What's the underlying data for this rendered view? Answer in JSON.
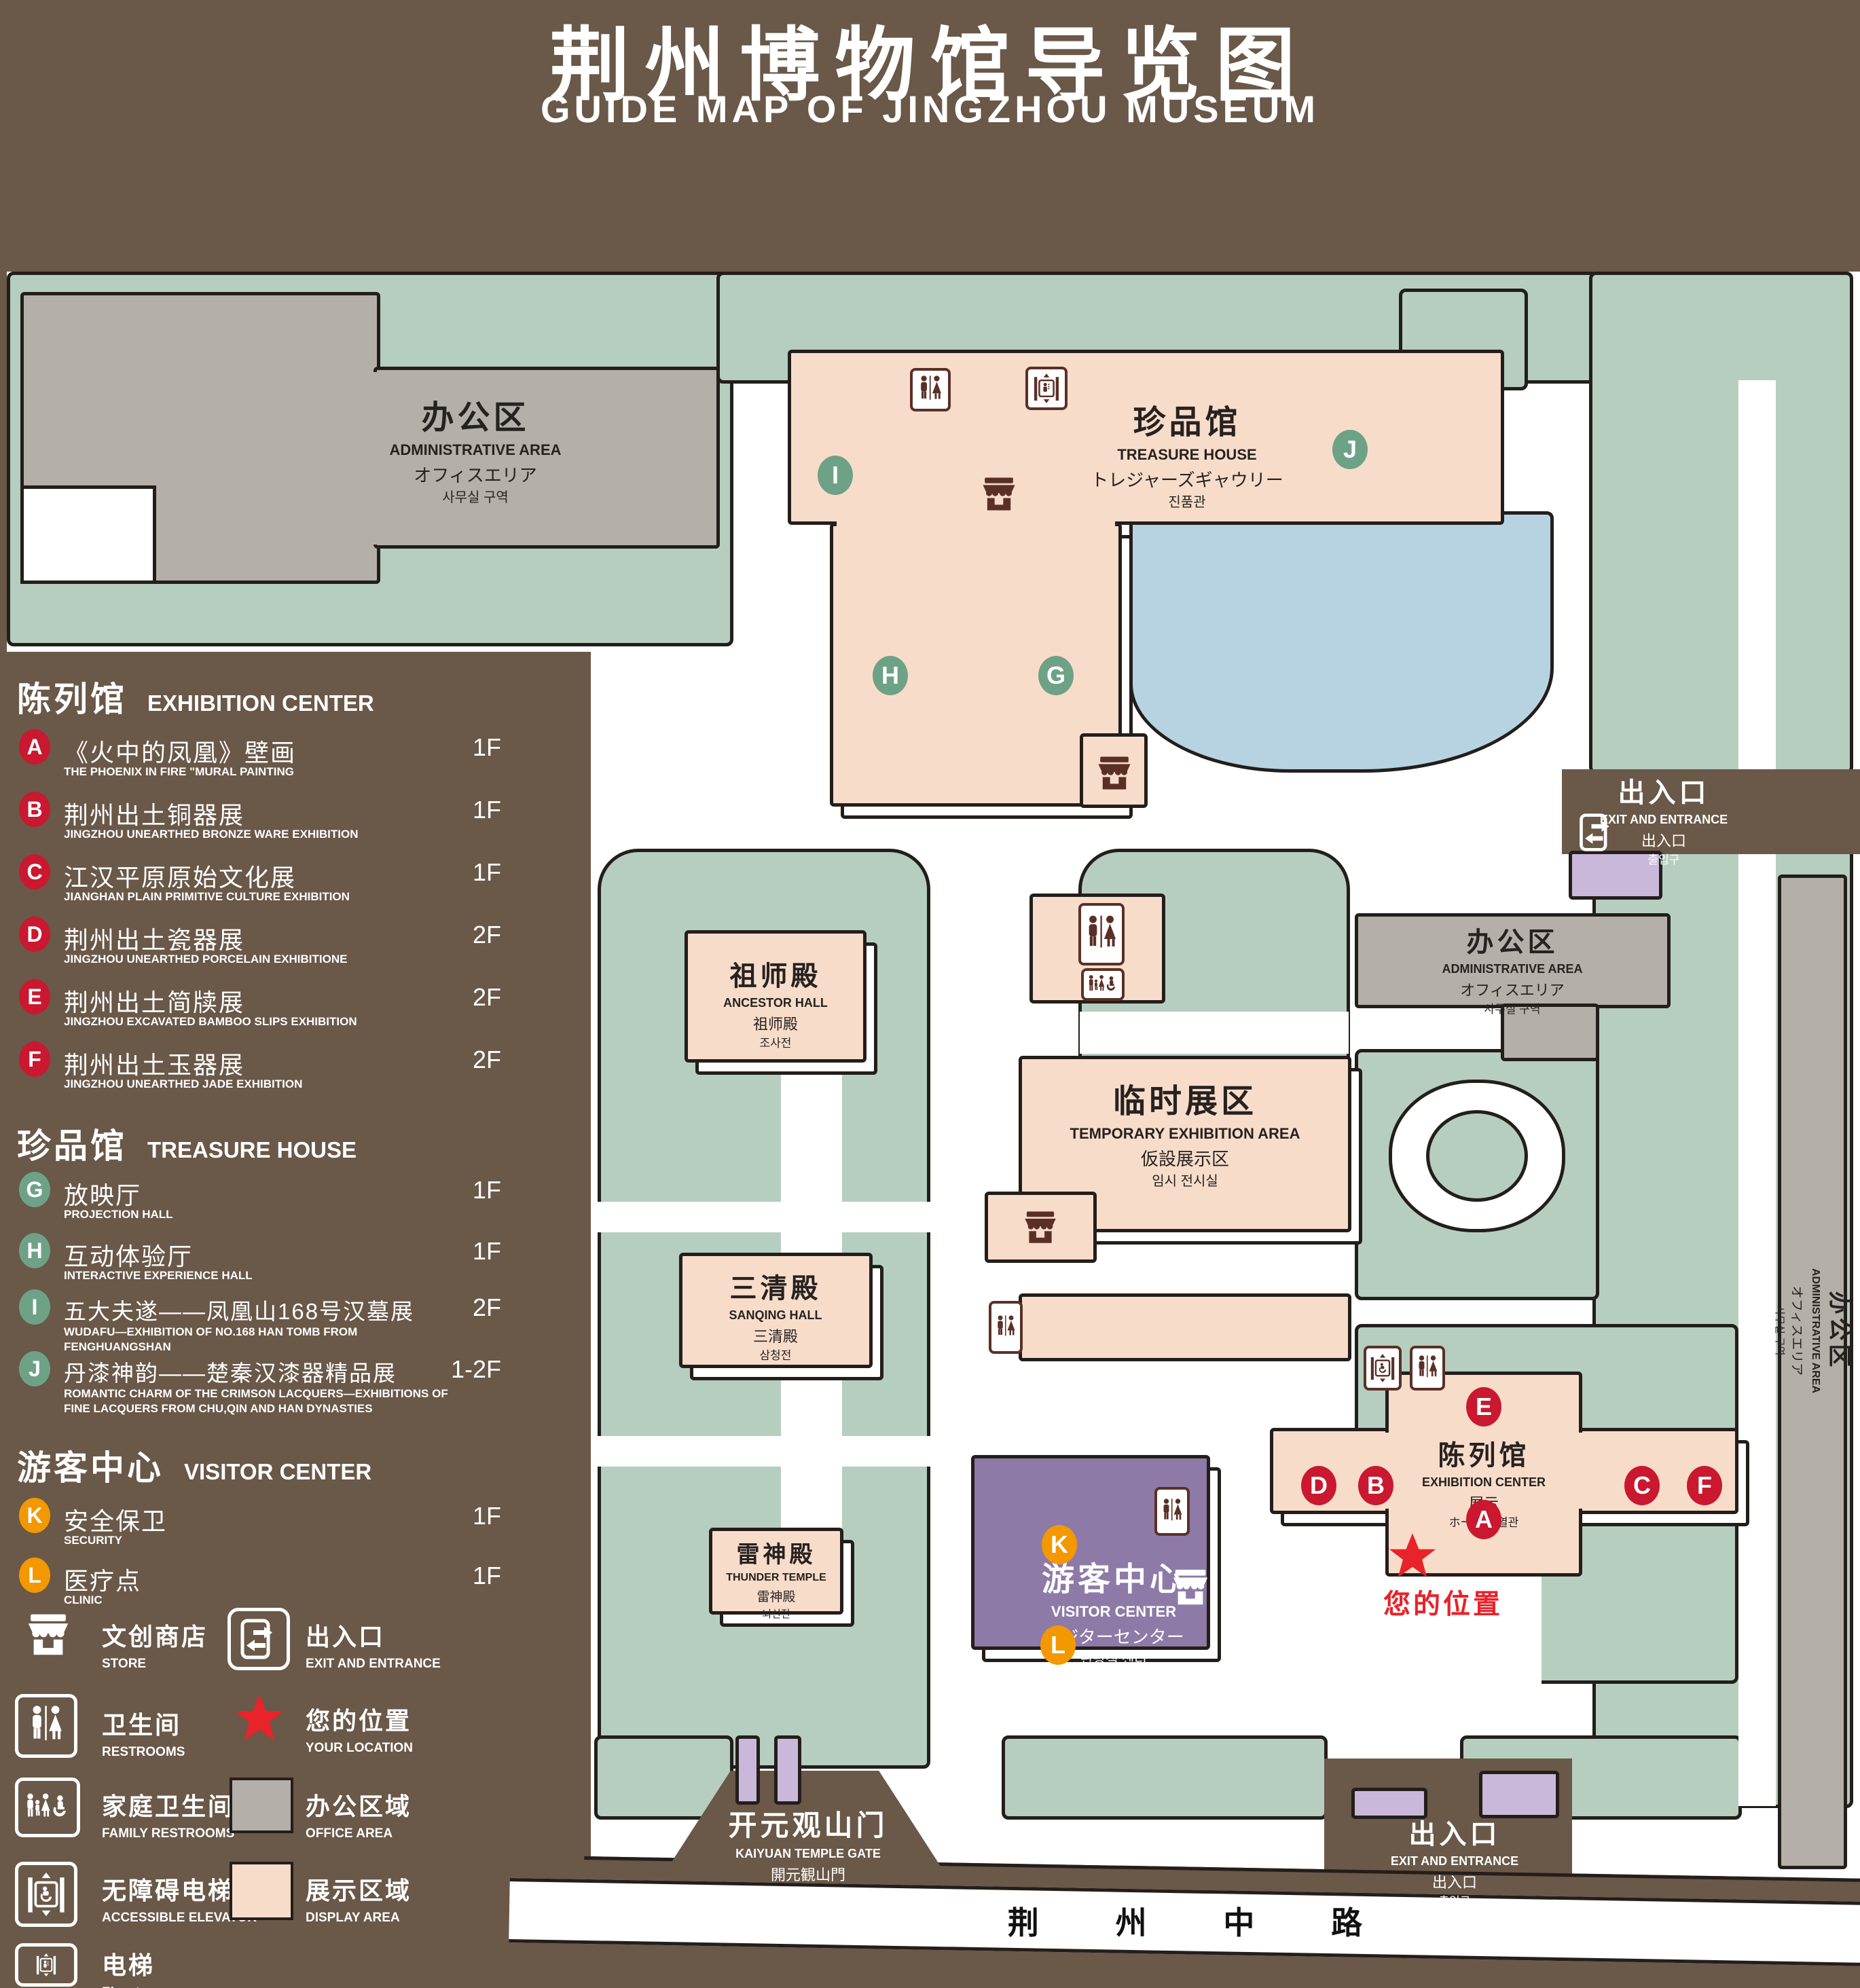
{
  "title": {
    "zh": "荆州博物馆导览图",
    "en": "GUIDE MAP OF JINGZHOU MUSEUM"
  },
  "legend": {
    "sections": [
      {
        "zh": "陈列馆",
        "en": "EXHIBITION CENTER",
        "marker_color": "#c9182f",
        "items": [
          {
            "letter": "A",
            "zh": "《火中的凤凰》壁画",
            "en": "THE PHOENIX IN FIRE \"MURAL PAINTING",
            "floor": "1F"
          },
          {
            "letter": "B",
            "zh": "荆州出土铜器展",
            "en": "JINGZHOU UNEARTHED BRONZE WARE EXHIBITION",
            "floor": "1F"
          },
          {
            "letter": "C",
            "zh": "江汉平原原始文化展",
            "en": "JIANGHAN PLAIN PRIMITIVE CULTURE EXHIBITION",
            "floor": "1F"
          },
          {
            "letter": "D",
            "zh": "荆州出土瓷器展",
            "en": "JINGZHOU UNEARTHED PORCELAIN EXHIBITIONE",
            "floor": "2F"
          },
          {
            "letter": "E",
            "zh": "荆州出土简牍展",
            "en": "JINGZHOU EXCAVATED BAMBOO SLIPS EXHIBITION",
            "floor": "2F"
          },
          {
            "letter": "F",
            "zh": "荆州出土玉器展",
            "en": "JINGZHOU UNEARTHED JADE EXHIBITION",
            "floor": "2F"
          }
        ]
      },
      {
        "zh": "珍品馆",
        "en": "TREASURE HOUSE",
        "marker_color": "#6ea287",
        "items": [
          {
            "letter": "G",
            "zh": "放映厅",
            "en": "PROJECTION HALL",
            "floor": "1F"
          },
          {
            "letter": "H",
            "zh": "互动体验厅",
            "en": "INTERACTIVE EXPERIENCE HALL",
            "floor": "1F"
          },
          {
            "letter": "I",
            "zh": "五大夫遂——凤凰山168号汉墓展",
            "en": "WUDAFU—EXHIBITION OF NO.168 HAN TOMB FROM FENGHUANGSHAN",
            "floor": "2F"
          },
          {
            "letter": "J",
            "zh": "丹漆神韵——楚秦汉漆器精品展",
            "en": "ROMANTIC CHARM OF THE CRIMSON LACQUERS—EXHIBITIONS OF FINE LACQUERS FROM CHU,QIN AND HAN DYNASTIES",
            "floor": "1-2F"
          }
        ]
      },
      {
        "zh": "游客中心",
        "en": "VISITOR CENTER",
        "marker_color": "#f39800",
        "items": [
          {
            "letter": "K",
            "zh": "安全保卫",
            "en": "SECURITY",
            "floor": "1F"
          },
          {
            "letter": "L",
            "zh": "医疗点",
            "en": "CLINIC",
            "floor": "1F"
          }
        ]
      }
    ],
    "symbols_left": [
      {
        "icon": "store-icon",
        "zh": "文创商店",
        "en": "STORE"
      },
      {
        "icon": "restrooms-icon",
        "zh": "卫生间",
        "en": "RESTROOMS"
      },
      {
        "icon": "family-restrooms-icon",
        "zh": "家庭卫生间",
        "en": "FAMILY RESTROOMS"
      },
      {
        "icon": "accessible-elevator-icon",
        "zh": "无障碍电梯",
        "en": "ACCESSIBLE ELEVATOR"
      },
      {
        "icon": "elevator-icon",
        "zh": "电梯",
        "en": "Elevator"
      }
    ],
    "symbols_right": [
      {
        "icon": "exit-icon",
        "zh": "出入口",
        "en": "EXIT AND ENTRANCE"
      },
      {
        "icon": "your-location-icon",
        "zh": "您的位置",
        "en": "YOUR LOCATION"
      },
      {
        "icon": "office-area-swatch",
        "zh": "办公区域",
        "en": "OFFICE AREA",
        "color": "#b4afa9"
      },
      {
        "icon": "display-area-swatch",
        "zh": "展示区域",
        "en": "DISPLAY AREA",
        "color": "#f8dcca"
      }
    ]
  },
  "map": {
    "buildings": {
      "admin_top": {
        "l1": "办公区",
        "l2": "ADMINISTRATIVE AREA",
        "l3": "オフィスエリア",
        "l4": "사무실 구역"
      },
      "treasure_house": {
        "l1": "珍品馆",
        "l2": "TREASURE HOUSE",
        "l3": "トレジャーズギャウリー",
        "l4": "진품관"
      },
      "ancestor_hall": {
        "l1": "祖师殿",
        "l2": "ANCESTOR HALL",
        "l3": "祖师殿",
        "l4": "조사전"
      },
      "temporary_exhibition": {
        "l1": "临时展区",
        "l2": "TEMPORARY EXHIBITION AREA",
        "l3": "仮設展示区",
        "l4": "임시 전시실"
      },
      "sanqing_hall": {
        "l1": "三清殿",
        "l2": "SANQING HALL",
        "l3": "三清殿",
        "l4": "삼청전"
      },
      "thunder_temple": {
        "l1": "雷神殿",
        "l2": "THUNDER TEMPLE",
        "l3": "雷神殿",
        "l4": "뇌신전"
      },
      "visitor_center": {
        "l1": "游客中心",
        "l2": "VISITOR CENTER",
        "l3": "ビジターセンター",
        "l4": "관광객 센터"
      },
      "exhibition_center": {
        "l1": "陈列馆",
        "l2": "EXHIBITION CENTER",
        "l3": "展示",
        "l4": "ホール 진열관"
      },
      "admin_right": {
        "l1": "办公区",
        "l2": "ADMINISTRATIVE AREA",
        "l3": "オフィスエリア",
        "l4": "사무실 구역"
      },
      "admin_far_right": {
        "l1": "办公区",
        "l2": "ADMINISTRATIVE AREA",
        "l3": "オフィスエリア",
        "l4": "사무실 구역"
      }
    },
    "labels": {
      "exit_top": {
        "l1": "出入口",
        "l2": "EXIT AND ENTRANCE",
        "l3": "出入口",
        "l4": "출입구"
      },
      "exit_bottom": {
        "l1": "出入口",
        "l2": "EXIT AND ENTRANCE",
        "l3": "出入口",
        "l4": "출입구"
      },
      "kaiyuan_gate": {
        "l1": "开元观山门",
        "l2": "KAIYUAN TEMPLE GATE",
        "l3": "開元観山門",
        "l4": "산문을 열다"
      },
      "your_location": "您的位置",
      "road": "荆 州 中 路"
    },
    "markers": {
      "A": "A",
      "B": "B",
      "C": "C",
      "D": "D",
      "E": "E",
      "F": "F",
      "G": "G",
      "H": "H",
      "I": "I",
      "J": "J",
      "K": "K",
      "L": "L"
    }
  }
}
